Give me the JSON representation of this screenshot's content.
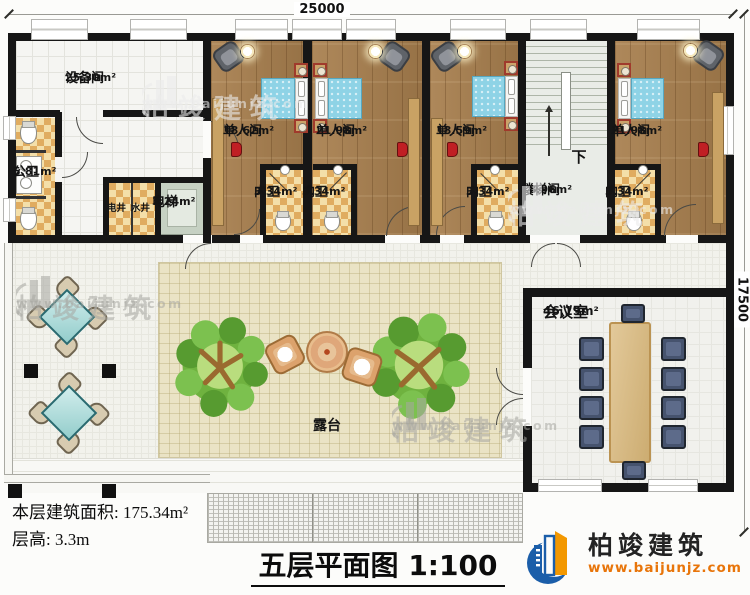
{
  "plan": {
    "dim_top": "25000",
    "dim_right": "17500",
    "stairs_down": "下",
    "rooms": {
      "equipment": {
        "name": "设备间",
        "area": "25.30m²"
      },
      "bedroom1": {
        "name": "单人间",
        "area": "18.62m²"
      },
      "bedroom2": {
        "name": "单人间",
        "area": "21.98m²"
      },
      "bedroom3": {
        "name": "单人间",
        "area": "18.59m²"
      },
      "bedroom4": {
        "name": "单人间",
        "area": "21.98m²"
      },
      "public_wc": {
        "name": "公卫",
        "area": "5.81m²"
      },
      "elec_shaft": {
        "name": "电井"
      },
      "water_shaft": {
        "name": "水井"
      },
      "elevator": {
        "name": "电梯",
        "area": "3.24m²"
      },
      "bath1": {
        "name": "内卫",
        "area": "3.34m²"
      },
      "bath2": {
        "name": "内卫",
        "area": "3.34m²"
      },
      "bath3": {
        "name": "内卫",
        "area": "3.34m²"
      },
      "bath4": {
        "name": "内卫",
        "area": "3.34m²"
      },
      "stairwell": {
        "name": "楼梯间",
        "area": "18.96m²"
      },
      "meeting": {
        "name": "会议室",
        "area": "46.19m²"
      },
      "terrace": {
        "name": "露台"
      }
    }
  },
  "footer": {
    "area_line": "本层建筑面积: 175.34m²",
    "height_line": "层高: 3.3m",
    "title": "五层平面图",
    "scale": "1:100"
  },
  "brand": {
    "name": "柏竣建筑",
    "url": "www.baijunjz.com"
  },
  "watermark": {
    "text": "柏竣建筑",
    "url": "www.baijunjz.com"
  },
  "colors": {
    "wall": "#161616",
    "wood_floor": "#a87f4e",
    "bath_tile": "#e0ac60",
    "quilt_blue": "#8ed3e6",
    "stair_floor": "#e9ece7",
    "terrace_pave": "#eae3c5",
    "brand_blue": "#1b5ea9",
    "brand_orange": "#f39800",
    "table_wood": "#d9b778",
    "meeting_chair": "#46536e",
    "tree_green": "#5ea136",
    "marker_red": "#c01f24"
  }
}
